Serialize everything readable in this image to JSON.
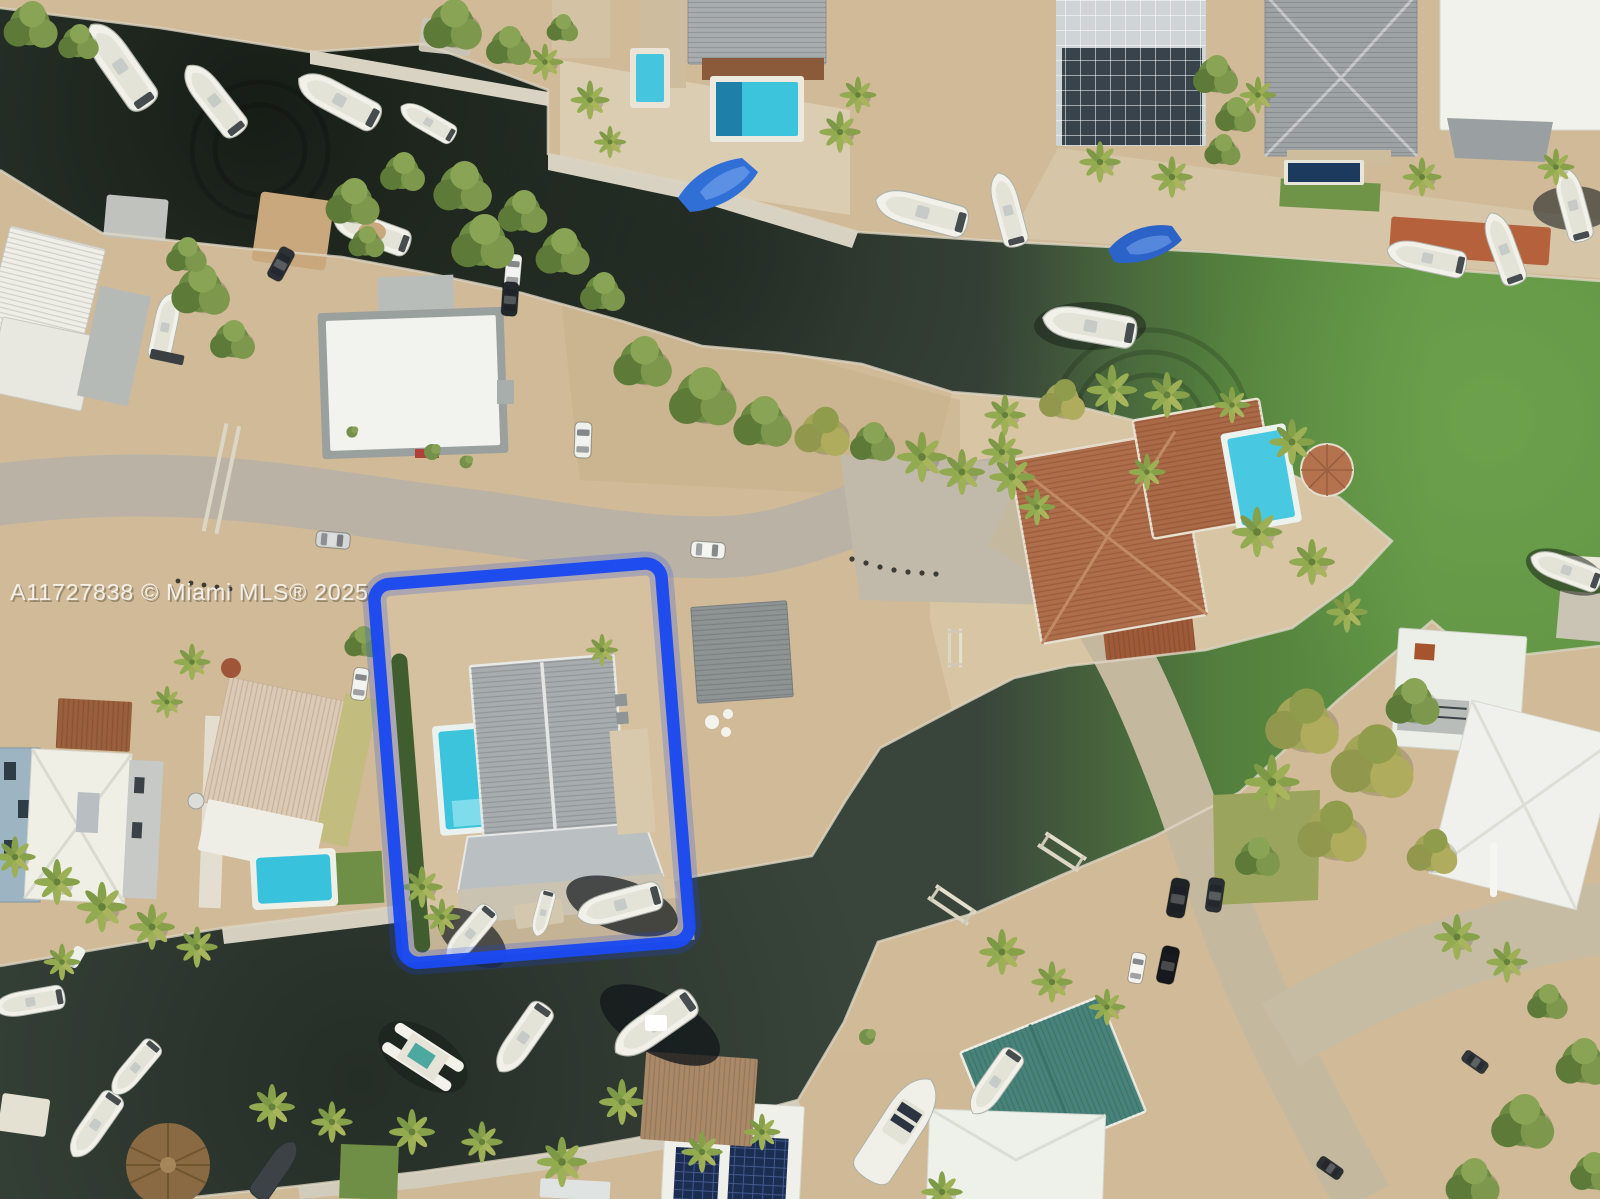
{
  "title": "Aerial drone photo of waterfront canal property",
  "watermark": {
    "text": "A11727838 © Miami MLS® 2025"
  },
  "highlight": {
    "color": "#1b49ef",
    "glow_color": "#1b49ef",
    "meaning": "subject property boundary outline"
  },
  "palette": {
    "canal_dark": "#2b352c",
    "canal_green": "#5f9340",
    "sand": "#d0ba97",
    "road": "#b9b2a4",
    "pool_cyan": "#3cc4dc",
    "metal_roof_gray": "#a7acae",
    "tile_roof_terracotta": "#ad6e4c",
    "teal_roof": "#47837a",
    "white_roof": "#efefe8"
  },
  "scene": {
    "type": "aerial-drone-photo",
    "setting": "waterfront canal neighborhood with docks",
    "features": [
      "upper canal with moored boats turning green to the east",
      "lower canal lined with boats on both banks",
      "subject property outlined in blue: gray metal gable-roof house, swimming pool, dock, three boats",
      "neighboring homes with pools and screened enclosure",
      "terracotta tile roof house with pool on peninsula",
      "sandy street with parked cars",
      "palm trees and tropical vegetation"
    ],
    "highlighted_property": {
      "house": "gray metal gable roof with porch",
      "pool": true,
      "dock": true,
      "boats_at_dock": 3,
      "hedge_west_boundary": true
    },
    "boats_visible_approx": 28,
    "pools_visible": 6,
    "cars_visible_approx": 12
  }
}
